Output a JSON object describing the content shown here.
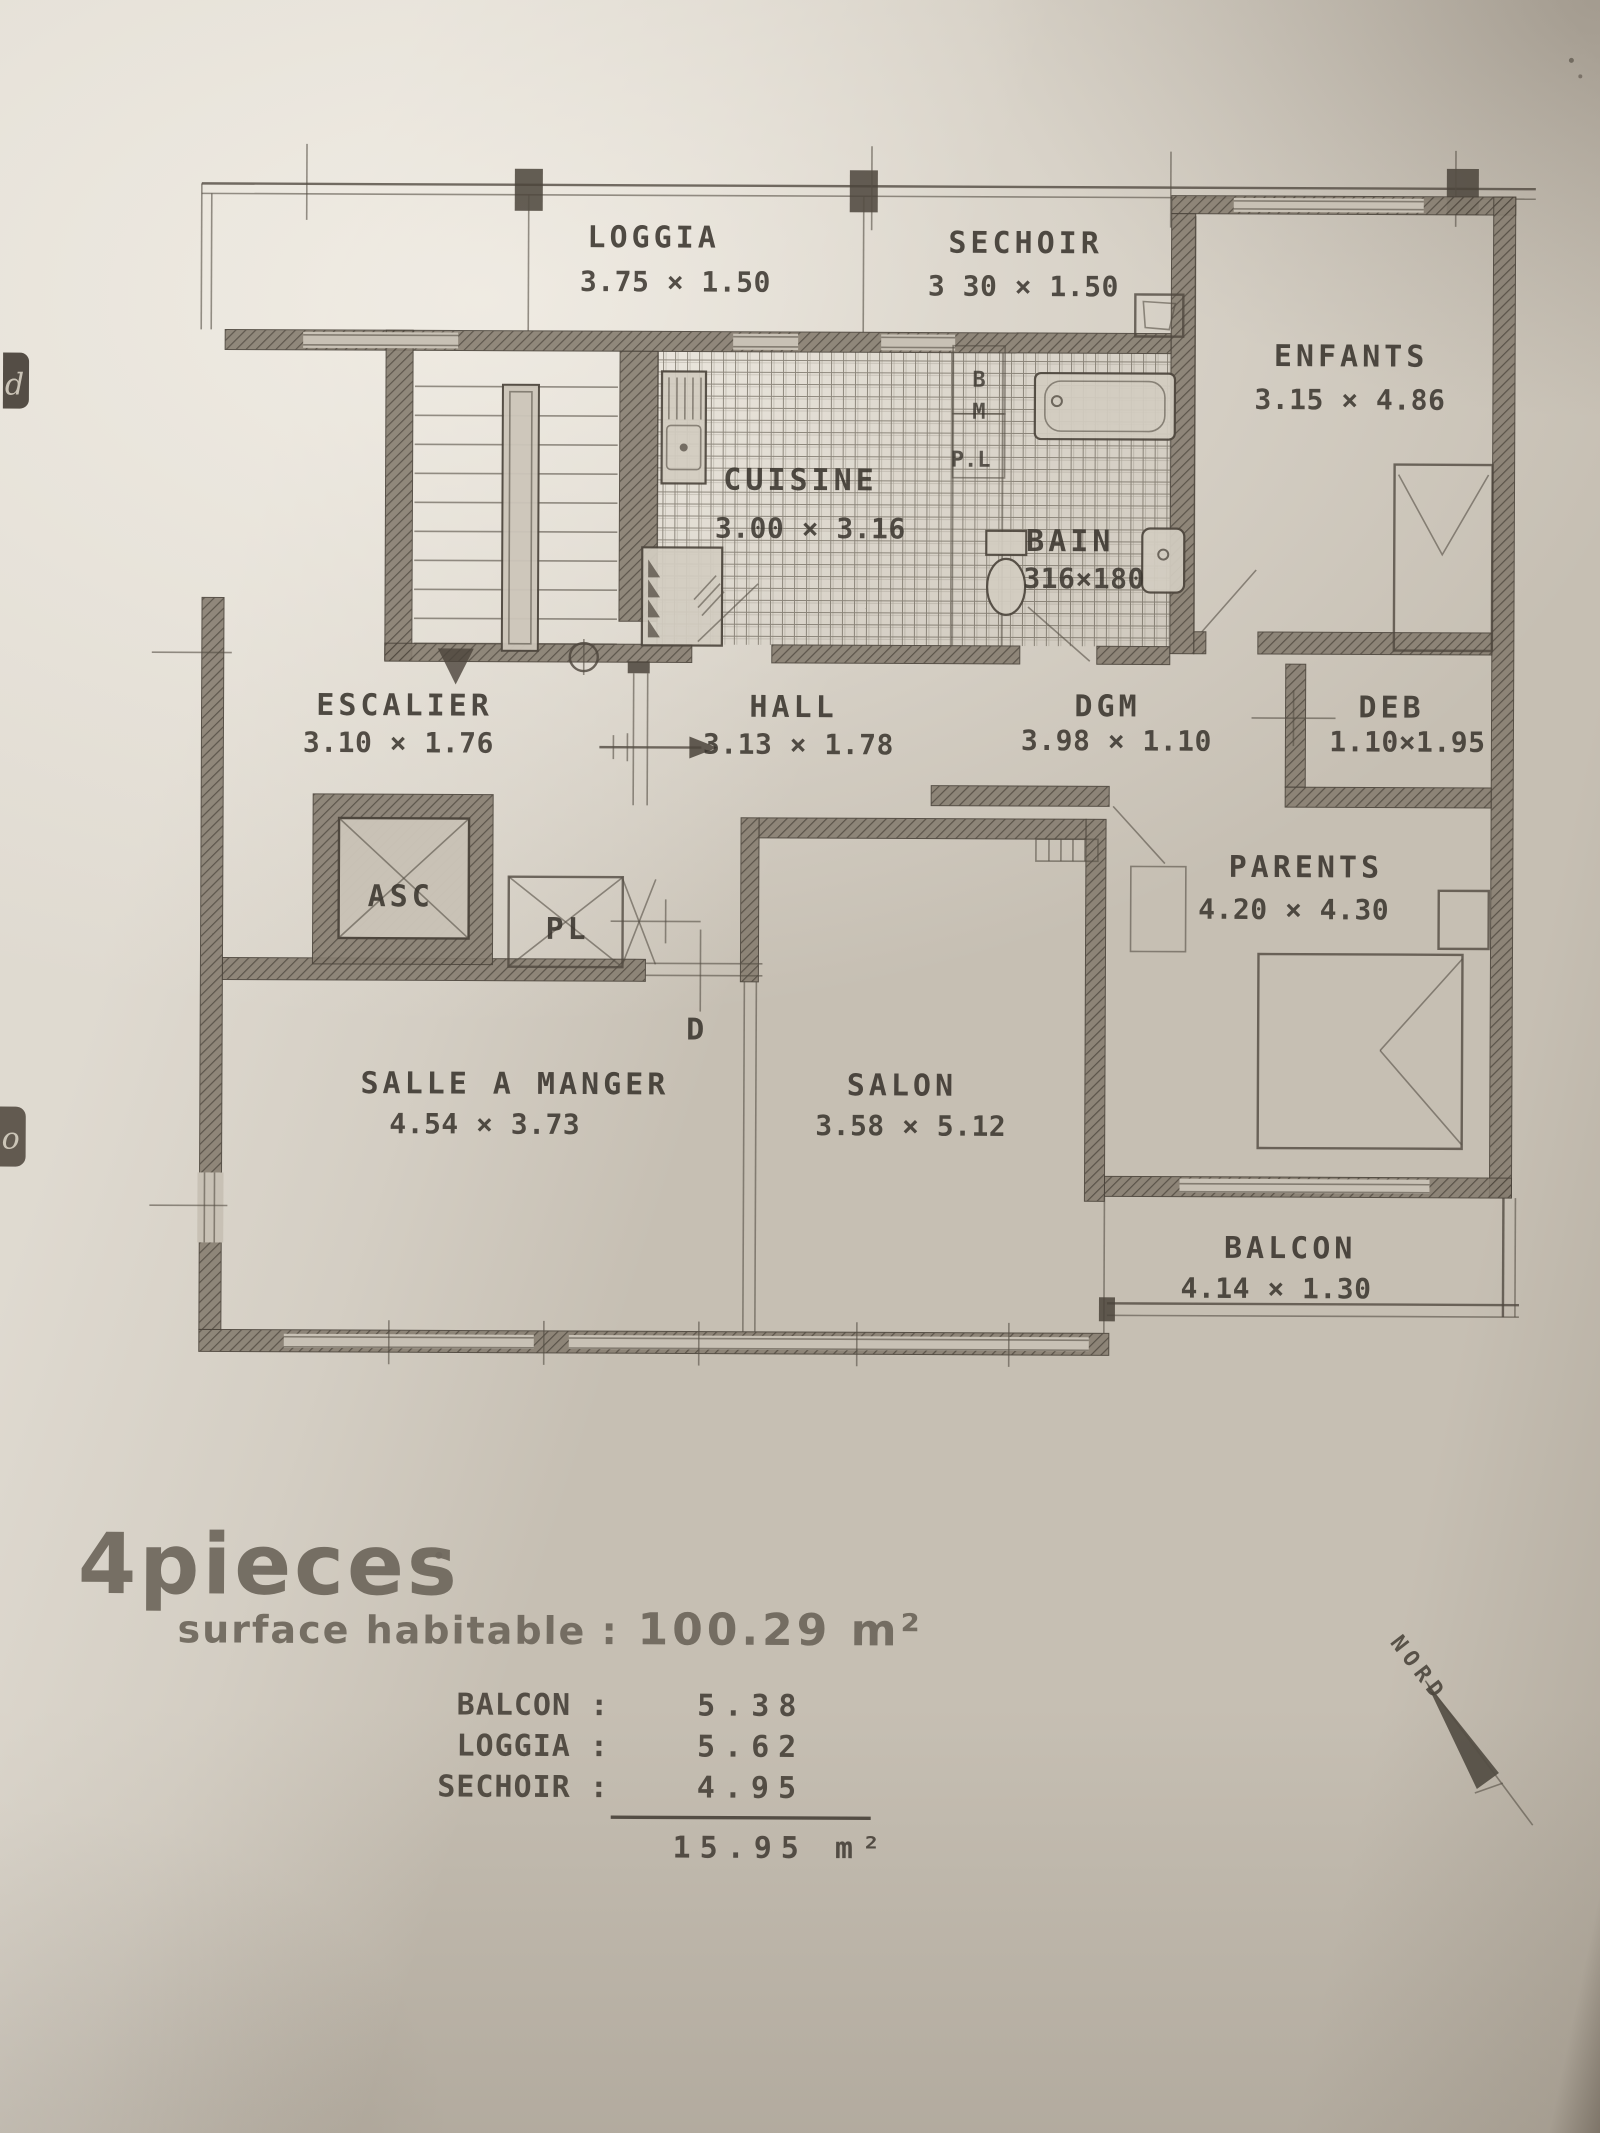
{
  "summary": {
    "title": "4pieces",
    "surface_label": "surface habitable :",
    "surface_value": "100.29 m²"
  },
  "rooms": {
    "loggia": {
      "name": "LOGGIA",
      "dims": "3.75 × 1.50"
    },
    "sechoir": {
      "name": "SECHOIR",
      "dims": "3 30 × 1.50"
    },
    "enfants": {
      "name": "ENFANTS",
      "dims": "3.15 × 4.86"
    },
    "cuisine": {
      "name": "CUISINE",
      "dims": "3.00 × 3.16"
    },
    "bain": {
      "name": "BAIN",
      "dims": "316×180"
    },
    "escalier": {
      "name": "ESCALIER",
      "dims": "3.10 × 1.76"
    },
    "hall": {
      "name": "HALL",
      "dims": "3.13 × 1.78"
    },
    "dgm": {
      "name": "DGM",
      "dims": "3.98 × 1.10"
    },
    "deb": {
      "name": "DEB",
      "dims": "1.10×1.95"
    },
    "parents": {
      "name": "PARENTS",
      "dims": "4.20 × 4.30"
    },
    "salle_a_manger": {
      "name": "SALLE A MANGER",
      "dims": "4.54 × 3.73"
    },
    "salon": {
      "name": "SALON",
      "dims": "3.58 × 5.12"
    },
    "balcon": {
      "name": "BALCON",
      "dims": "4.14 × 1.30"
    }
  },
  "plan_labels": {
    "asc": "ASC",
    "pl": "PL",
    "pl_small": "P.L",
    "closet_b": "B",
    "closet_m": "M",
    "door_d": "D"
  },
  "annex_table": {
    "rows": [
      {
        "label": "BALCON :",
        "value": "5.38"
      },
      {
        "label": "LOGGIA :",
        "value": "5.62"
      },
      {
        "label": "SECHOIR :",
        "value": "4.95"
      }
    ],
    "total": "15.95 m²"
  },
  "compass": {
    "label": "NORD"
  },
  "edge_marks": {
    "top": "d",
    "bottom": "o"
  },
  "colors": {
    "paper": "#c6bfb3",
    "ink": "#4b443b",
    "stamp": "#6e675c"
  }
}
